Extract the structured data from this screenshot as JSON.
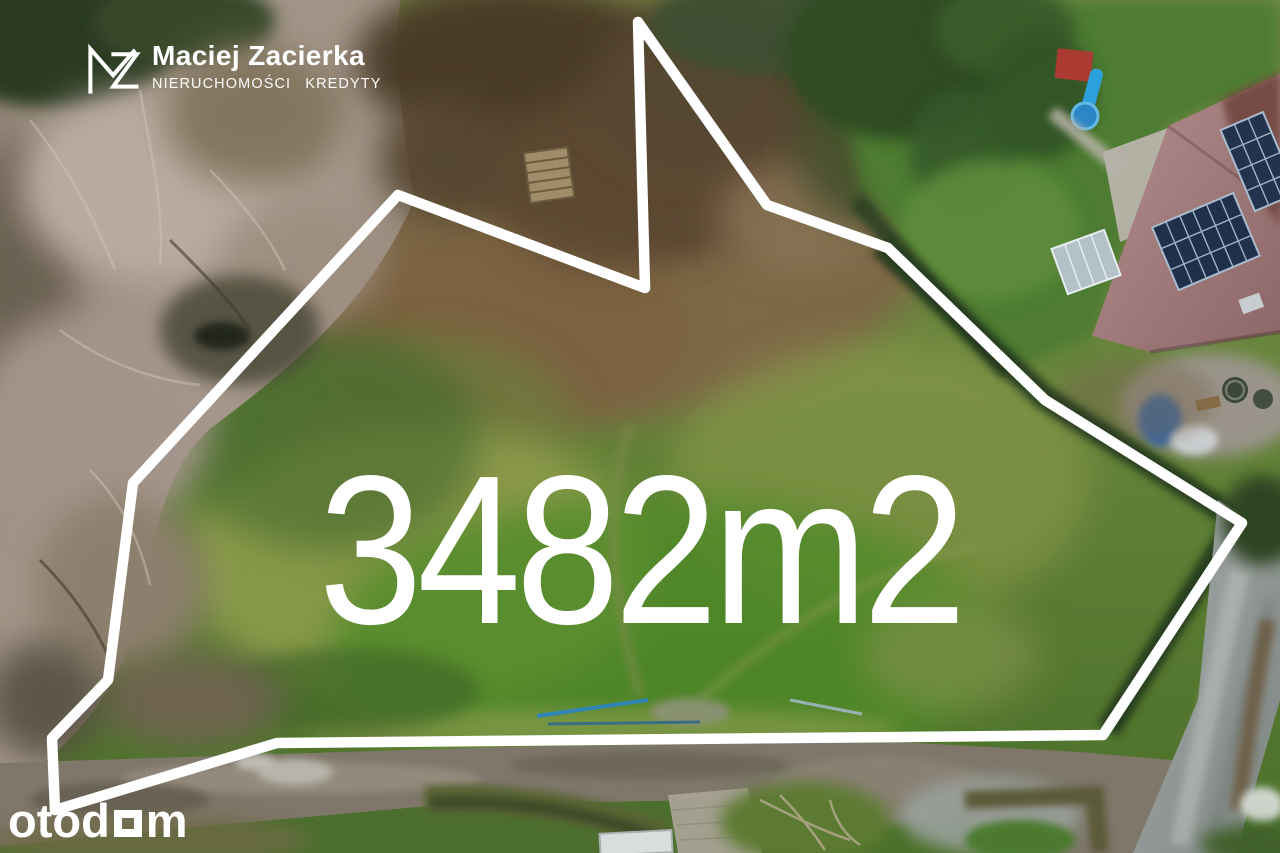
{
  "branding": {
    "monogram": "MZ",
    "agent_name": "Maciej Zacierka",
    "agent_tagline": "NIERUCHOMOŚCI KREDYTY"
  },
  "plot": {
    "area_label": "3482m2",
    "area_value": 3482,
    "area_unit": "m2",
    "outline_points": "398,195 645,288 638,22 767,205 888,248 1045,400 1242,523 1103,735 277,743 55,810 52,738 108,680 133,483",
    "outline_color": "#ffffff"
  },
  "watermark": {
    "prefix": "otod",
    "suffix": "m",
    "full_name": "otodom"
  },
  "palette": {
    "overlay_white": "#ffffff",
    "field_green": "#5a7f31",
    "bright_grass_green": "#4b8a28",
    "dry_meadow_brown": "#7d6847",
    "woodland_taupe": "#a89a8e",
    "forest_dark_green": "#2c3b24",
    "roof_mauve": "#a98689",
    "solar_panel_blue": "#20304a",
    "asphalt_gray": "#9aa3a1",
    "dirt_road_tan": "#7e776a"
  }
}
